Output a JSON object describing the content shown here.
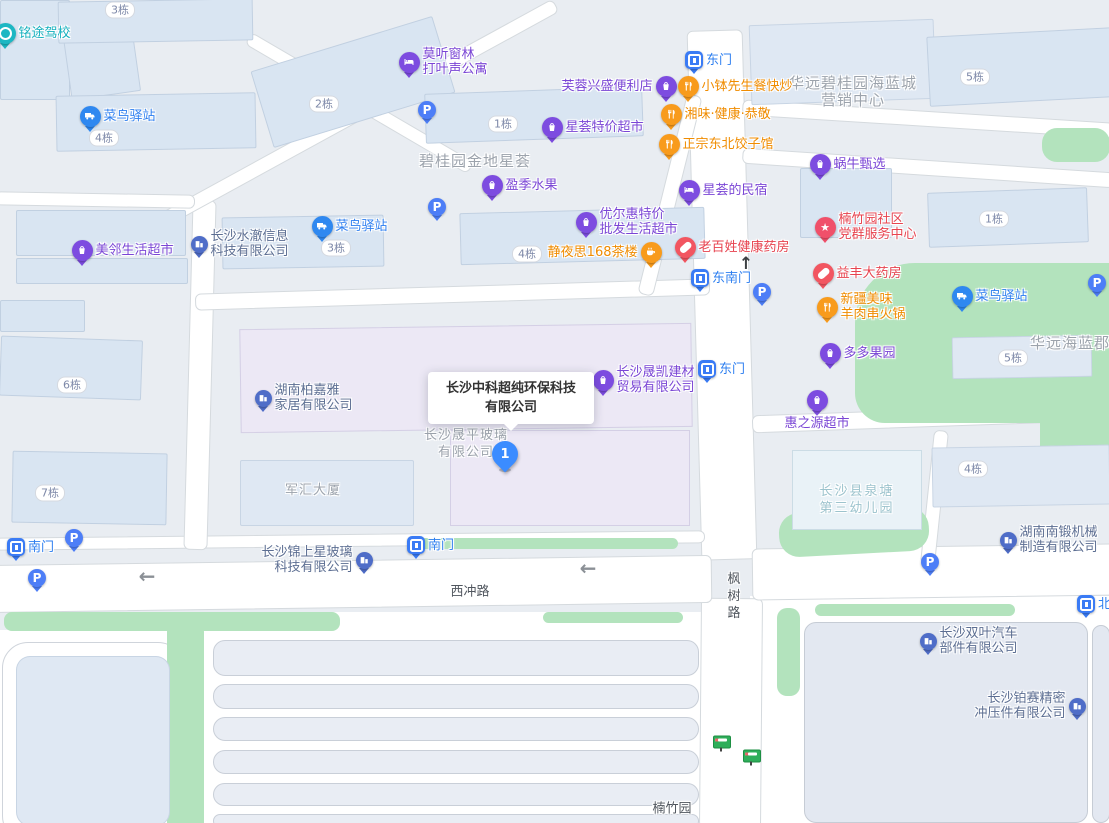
{
  "palette": {
    "blue_pin": "#2f88f0",
    "gate_pin": "#3a7bf5",
    "parking_pin": "#4d7ef7",
    "purple_pin": "#7d4ce0",
    "orange_pin": "#f89b1c",
    "red_pin": "#f25661",
    "community_pin": "#f0506a",
    "teal_pin": "#1db7c3",
    "company_pin": "#4f6dc8",
    "marker_blue": "#3b8cff",
    "green_area": "#b3e3bd",
    "blue_label": "#2e7ff0",
    "purple_label": "#7a45d5",
    "orange_label": "#f08c00",
    "red_label": "#e7434f",
    "teal_label": "#15b0be",
    "company_label": "#5c6e92",
    "area_label": "#9ca3ac",
    "kindergarten_label": "#9cc3cd",
    "road_label": "#50565e"
  },
  "map": {
    "selected_place": {
      "line1": "长沙中科超纯环保科技",
      "line2": "有限公司",
      "marker_number": "1"
    },
    "pins": [
      {
        "name": "mingtu-driving-school",
        "type": "school",
        "x": 5,
        "y": 33,
        "lines": [
          "铭途驾校"
        ],
        "side": "r"
      },
      {
        "name": "cainiao-station-nw",
        "type": "cainiao",
        "x": 90,
        "y": 116,
        "lines": [
          "菜鸟驿站"
        ],
        "side": "r"
      },
      {
        "name": "cainiao-station-mid",
        "type": "cainiao",
        "x": 322,
        "y": 226,
        "lines": [
          "菜鸟驿站"
        ],
        "side": "r"
      },
      {
        "name": "meilin-supermarket",
        "type": "shop",
        "x": 82,
        "y": 250,
        "lines": [
          "美邻生活超市"
        ],
        "side": "r"
      },
      {
        "name": "shuiche-info-company",
        "type": "company",
        "x": 199,
        "y": 244,
        "lines": [
          "长沙水澈信息",
          "科技有限公司"
        ],
        "side": "r"
      },
      {
        "name": "moting-apartment",
        "type": "hotel",
        "x": 409,
        "y": 62,
        "lines": [
          "莫听窗林",
          "打叶声公寓"
        ],
        "side": "r"
      },
      {
        "name": "parking-1",
        "type": "parking",
        "x": 427,
        "y": 110,
        "lines": [],
        "side": "r"
      },
      {
        "name": "furong-store",
        "type": "shop",
        "x": 666,
        "y": 86,
        "lines": [
          "芙蓉兴盛便利店"
        ],
        "side": "l"
      },
      {
        "name": "east-gate-top",
        "type": "gate",
        "x": 694,
        "y": 60,
        "lines": [
          "东门"
        ],
        "side": "r"
      },
      {
        "name": "xiaobo-restaurant",
        "type": "food",
        "x": 688,
        "y": 86,
        "lines": [
          "小钵先生餐快炒"
        ],
        "side": "r"
      },
      {
        "name": "xiangwei-restaurant",
        "type": "food",
        "x": 671,
        "y": 114,
        "lines": [
          "湘味·健康·恭敬"
        ],
        "side": "r"
      },
      {
        "name": "dongbei-dumplings",
        "type": "food",
        "x": 669,
        "y": 144,
        "lines": [
          "正宗东北饺子馆"
        ],
        "side": "r"
      },
      {
        "name": "xinghui-supermarket",
        "type": "shop",
        "x": 552,
        "y": 127,
        "lines": [
          "星荟特价超市"
        ],
        "side": "r"
      },
      {
        "name": "yingji-fruit",
        "type": "shop",
        "x": 492,
        "y": 185,
        "lines": [
          "盈季水果"
        ],
        "side": "r"
      },
      {
        "name": "parking-2",
        "type": "parking",
        "x": 437,
        "y": 207,
        "lines": [],
        "side": "r"
      },
      {
        "name": "youerhui-supermarket",
        "type": "shop",
        "x": 586,
        "y": 222,
        "lines": [
          "优尔惠特价",
          "批发生活超市"
        ],
        "side": "r"
      },
      {
        "name": "jingyesi-teahouse",
        "type": "tea",
        "x": 651,
        "y": 252,
        "lines": [
          "静夜思168茶楼"
        ],
        "side": "l"
      },
      {
        "name": "laobaixing-pharmacy",
        "type": "pharmacy",
        "x": 685,
        "y": 247,
        "lines": [
          "老百姓健康药房"
        ],
        "side": "r"
      },
      {
        "name": "xinghui-homestay",
        "type": "hotel",
        "x": 689,
        "y": 190,
        "lines": [
          "星荟的民宿"
        ],
        "side": "r"
      },
      {
        "name": "woniu-select",
        "type": "shop",
        "x": 820,
        "y": 164,
        "lines": [
          "蜗牛甄选"
        ],
        "side": "r"
      },
      {
        "name": "nanzhuyuan-community-center",
        "type": "community",
        "x": 825,
        "y": 227,
        "lines": [
          "楠竹园社区",
          "党群服务中心"
        ],
        "side": "r"
      },
      {
        "name": "yifeng-pharmacy",
        "type": "pharmacy",
        "x": 823,
        "y": 273,
        "lines": [
          "益丰大药房"
        ],
        "side": "r"
      },
      {
        "name": "southeast-gate",
        "type": "gate",
        "x": 700,
        "y": 278,
        "lines": [
          "东南门"
        ],
        "side": "r"
      },
      {
        "name": "parking-3",
        "type": "parking",
        "x": 762,
        "y": 292,
        "lines": [],
        "side": "r"
      },
      {
        "name": "xinjiang-bbq",
        "type": "food",
        "x": 827,
        "y": 307,
        "lines": [
          "新疆美味",
          "羊肉串火锅"
        ],
        "side": "r"
      },
      {
        "name": "cainiao-station-east",
        "type": "cainiao",
        "x": 962,
        "y": 296,
        "lines": [
          "菜鸟驿站"
        ],
        "side": "r"
      },
      {
        "name": "parking-4",
        "type": "parking",
        "x": 1097,
        "y": 283,
        "lines": [],
        "side": "r"
      },
      {
        "name": "duoduo-orchard",
        "type": "shop",
        "x": 830,
        "y": 353,
        "lines": [
          "多多果园"
        ],
        "side": "r"
      },
      {
        "name": "east-gate-mid",
        "type": "gate",
        "x": 707,
        "y": 369,
        "lines": [
          "东门"
        ],
        "side": "r"
      },
      {
        "name": "shengkai-building-materials",
        "type": "shop",
        "x": 603,
        "y": 380,
        "lines": [
          "长沙晟凯建材",
          "贸易有限公司"
        ],
        "side": "r"
      },
      {
        "name": "bojiaya-furniture",
        "type": "company",
        "x": 263,
        "y": 398,
        "lines": [
          "湖南柏嘉雅",
          "家居有限公司"
        ],
        "side": "r"
      },
      {
        "name": "huizhiyuan-supermarket",
        "type": "shop",
        "x": 817,
        "y": 400,
        "lines": [
          "惠之源超市"
        ],
        "side": "b"
      },
      {
        "name": "south-gate-west",
        "type": "gate",
        "x": 16,
        "y": 547,
        "lines": [
          "南门"
        ],
        "side": "r"
      },
      {
        "name": "parking-5",
        "type": "parking",
        "x": 74,
        "y": 538,
        "lines": [],
        "side": "r"
      },
      {
        "name": "parking-6",
        "type": "parking",
        "x": 37,
        "y": 578,
        "lines": [],
        "side": "r"
      },
      {
        "name": "south-gate-mid",
        "type": "gate",
        "x": 416,
        "y": 545,
        "lines": [
          "南门"
        ],
        "side": "r"
      },
      {
        "name": "jinshangxing-glass",
        "type": "company",
        "x": 364,
        "y": 560,
        "lines": [
          "长沙锦上星玻璃",
          "科技有限公司"
        ],
        "side": "l"
      },
      {
        "name": "nanduan-machinery",
        "type": "company",
        "x": 1008,
        "y": 540,
        "lines": [
          "湖南南锻机械",
          "制造有限公司"
        ],
        "side": "r"
      },
      {
        "name": "parking-7",
        "type": "parking",
        "x": 930,
        "y": 562,
        "lines": [],
        "side": "r"
      },
      {
        "name": "north-gate",
        "type": "gate",
        "x": 1086,
        "y": 604,
        "lines": [
          "北门"
        ],
        "side": "r"
      },
      {
        "name": "shuangye-auto-parts",
        "type": "company",
        "x": 928,
        "y": 641,
        "lines": [
          "长沙双叶汽车",
          "部件有限公司"
        ],
        "side": "r"
      },
      {
        "name": "bosai-precision-stamping",
        "type": "company",
        "x": 1077,
        "y": 706,
        "lines": [
          "长沙铂赛精密",
          "冲压件有限公司"
        ],
        "side": "l"
      }
    ],
    "building_badges": [
      {
        "text": "3栋",
        "x": 120,
        "y": 10
      },
      {
        "text": "4栋",
        "x": 104,
        "y": 138
      },
      {
        "text": "2栋",
        "x": 324,
        "y": 104
      },
      {
        "text": "1栋",
        "x": 503,
        "y": 124
      },
      {
        "text": "3栋",
        "x": 336,
        "y": 248
      },
      {
        "text": "4栋",
        "x": 527,
        "y": 254
      },
      {
        "text": "5栋",
        "x": 975,
        "y": 77
      },
      {
        "text": "1栋",
        "x": 994,
        "y": 219
      },
      {
        "text": "5栋",
        "x": 1013,
        "y": 358
      },
      {
        "text": "4栋",
        "x": 973,
        "y": 469
      },
      {
        "text": "6栋",
        "x": 72,
        "y": 385
      },
      {
        "text": "7栋",
        "x": 50,
        "y": 493
      }
    ],
    "area_labels": [
      {
        "lines": [
          "碧桂园金地星荟"
        ],
        "x": 475,
        "y": 161,
        "style": "lg"
      },
      {
        "lines": [
          "华远碧桂园海蓝城",
          "营销中心"
        ],
        "x": 853,
        "y": 92,
        "style": "lg"
      },
      {
        "lines": [
          "华远海蓝郡"
        ],
        "x": 1070,
        "y": 343,
        "style": "lg"
      },
      {
        "lines": [
          "军汇大厦"
        ],
        "x": 313,
        "y": 490,
        "style": "md"
      },
      {
        "lines": [
          "长沙晟平玻璃",
          "有限公司"
        ],
        "x": 466,
        "y": 444,
        "style": "md"
      },
      {
        "lines": [
          "长沙县泉塘",
          "第三幼儿园"
        ],
        "x": 857,
        "y": 500,
        "style": "teal"
      }
    ],
    "road_labels": [
      {
        "text": "西冲路",
        "x": 470,
        "y": 590,
        "vertical": false
      },
      {
        "text": "枫树路",
        "x": 732,
        "y": 597,
        "vertical": true
      },
      {
        "text": "楠竹园",
        "x": 672,
        "y": 807,
        "vertical": false
      }
    ],
    "arrows": [
      {
        "dir": "left",
        "x": 147,
        "y": 576
      },
      {
        "dir": "left",
        "x": 588,
        "y": 568
      },
      {
        "dir": "up",
        "x": 746,
        "y": 264
      }
    ],
    "bus_stops": [
      {
        "x": 722,
        "y": 742
      },
      {
        "x": 752,
        "y": 756
      }
    ]
  }
}
